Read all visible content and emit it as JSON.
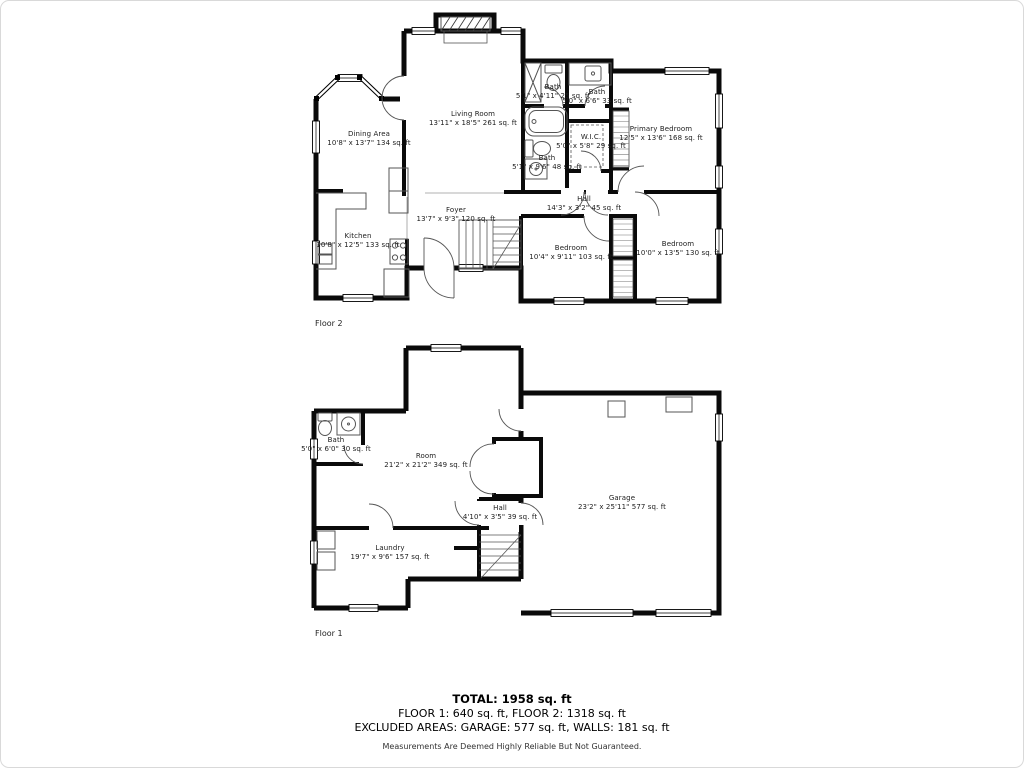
{
  "floor2": {
    "caption": "Floor 2",
    "rooms": [
      {
        "name": "Living Room",
        "dims": "13'11\" x 18'5\" 261 sq. ft"
      },
      {
        "name": "Dining Area",
        "dims": "10'8\" x 13'7\" 134 sq. ft"
      },
      {
        "name": "Kitchen",
        "dims": "10'8\" x 12'5\" 133 sq. ft"
      },
      {
        "name": "Foyer",
        "dims": "13'7\" x 9'3\" 120 sq. ft"
      },
      {
        "name": "Bath",
        "dims": "5'1\" x 4'11\" 25 sq. ft"
      },
      {
        "name": "Bath",
        "dims": "5'0\" x 6'6\" 33 sq. ft"
      },
      {
        "name": "Bath",
        "dims": "5'1\" x 9'6\" 48 sq. ft"
      },
      {
        "name": "W.I.C.",
        "dims": "5'0\" x 5'8\" 29 sq. ft"
      },
      {
        "name": "Primary Bedroom",
        "dims": "12'5\" x 13'6\" 168 sq. ft"
      },
      {
        "name": "Hall",
        "dims": "14'3\" x 3'2\" 45 sq. ft"
      },
      {
        "name": "Bedroom",
        "dims": "10'4\" x 9'11\" 103 sq. ft"
      },
      {
        "name": "Bedroom",
        "dims": "10'0\" x 13'5\" 130 sq. ft"
      }
    ]
  },
  "floor1": {
    "caption": "Floor 1",
    "rooms": [
      {
        "name": "Bath",
        "dims": "5'0\" x 6'0\" 30 sq. ft"
      },
      {
        "name": "Room",
        "dims": "21'2\" x 21'2\" 349 sq. ft"
      },
      {
        "name": "Hall",
        "dims": "4'10\" x 3'5\" 39 sq. ft"
      },
      {
        "name": "Garage",
        "dims": "23'2\" x 25'11\" 577 sq. ft"
      },
      {
        "name": "Laundry",
        "dims": "19'7\" x 9'6\" 157 sq. ft"
      }
    ]
  },
  "summary": {
    "total": "TOTAL: 1958 sq. ft",
    "floors": "FLOOR 1: 640 sq. ft, FLOOR 2: 1318 sq. ft",
    "excluded": "EXCLUDED AREAS: GARAGE: 577 sq. ft, WALLS: 181 sq. ft",
    "disclaimer": "Measurements Are Deemed Highly Reliable But Not Guaranteed."
  }
}
